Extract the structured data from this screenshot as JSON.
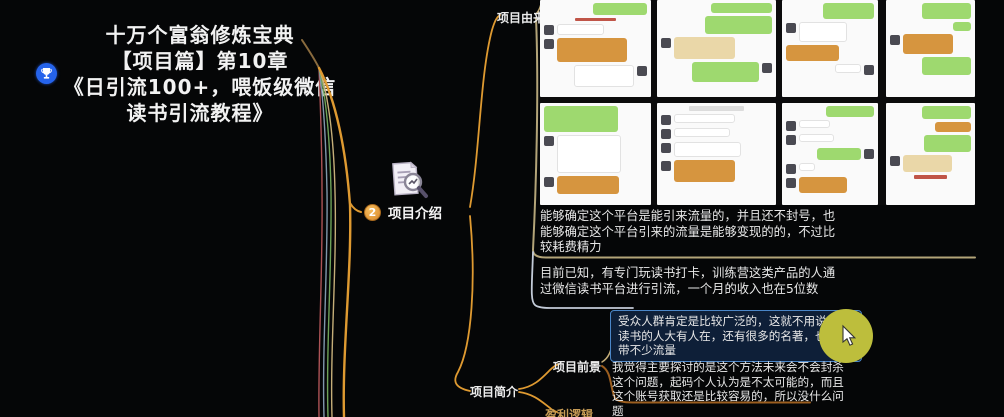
{
  "root_node": {
    "title_lines": [
      "十万个富翁修炼宝典",
      "【项目篇】第10章",
      "《日引流100+，喂饭级微信",
      "读书引流教程》"
    ],
    "marker_icon": "trophy-icon"
  },
  "intro_node": {
    "badge_number": "2",
    "label": "项目介绍",
    "icon": "document-search-icon"
  },
  "branch_labels": {
    "origin": "项目由来",
    "prospect": "项目前景",
    "summary": "项目简介",
    "profit": "盈利逻辑"
  },
  "notes": {
    "note1": "能够确定这个平台是能引来流量的，并且还不封号，也能够确定这个平台引来的流量是能够变现的的，不过比较耗费精力",
    "note2": "目前已知，有专门玩读书打卡，训练营这类产品的人通过微信读书平台进行引流，一个月的收入也在5位数",
    "note3_selected": "受众人群肯定是比较广泛的，这就不用说了，读书的人大有人在，还有很多的名著，也都自带不少流量",
    "note4": "我觉得主要探讨的是这个方法未来会不会封杀这个问题，起码个人认为是不太可能的，而且这个账号获取还是比较容易的，所以没什么问题"
  },
  "colors": {
    "background": "#050607",
    "branch_orange": "#df9a31",
    "branch_tan": "#c5ae79",
    "branch_green": "#6da257",
    "branch_slate": "#8097ab",
    "branch_red": "#ad5356",
    "underline_tan": "#b3a478",
    "underline_light": "#c3cbd8",
    "underline_brown": "#9c5e1f",
    "selection_border": "#4a86c8",
    "selection_bg": "#0e1f38",
    "cursor_highlight": "#bdbe3c",
    "badge_orange": "#e8a33c",
    "marker_blue": "#2563eb",
    "wechat_green": "#9ed96f",
    "bubble_orange": "#d6953f",
    "bubble_beige": "#ead7a8"
  },
  "collage": {
    "description": "wechat-chat-screenshot-collage",
    "cells": [
      {
        "x": 0,
        "y": 0,
        "w": 111,
        "h": 97,
        "bubbles": [
          {
            "s": "r",
            "c": "green",
            "w": 52,
            "h": 12
          },
          {
            "s": "m",
            "c": "redline",
            "w": 40,
            "h": 3
          },
          {
            "s": "l",
            "c": "white",
            "w": 46,
            "h": 11,
            "av": 1
          },
          {
            "s": "l",
            "c": "orange",
            "w": 68,
            "h": 24,
            "av": 1
          },
          {
            "s": "r",
            "c": "white",
            "w": 58,
            "h": 22,
            "av": 1
          }
        ]
      },
      {
        "x": 117,
        "y": 0,
        "w": 119,
        "h": 97,
        "bubbles": [
          {
            "s": "r",
            "c": "green",
            "w": 55,
            "h": 10
          },
          {
            "s": "r",
            "c": "green",
            "w": 60,
            "h": 18
          },
          {
            "s": "l",
            "c": "beige",
            "w": 55,
            "h": 22,
            "av": 1
          },
          {
            "s": "r",
            "c": "green",
            "w": 60,
            "h": 20,
            "av": 1
          }
        ]
      },
      {
        "x": 242,
        "y": 0,
        "w": 96,
        "h": 97,
        "bubbles": [
          {
            "s": "r",
            "c": "green",
            "w": 58,
            "h": 16
          },
          {
            "s": "l",
            "c": "white",
            "w": 55,
            "h": 20,
            "av": 1
          },
          {
            "s": "l",
            "c": "orange",
            "w": 60,
            "h": 16
          },
          {
            "s": "r",
            "c": "white",
            "w": 30,
            "h": 9,
            "av": 1
          }
        ]
      },
      {
        "x": 346,
        "y": 0,
        "w": 89,
        "h": 97,
        "bubbles": [
          {
            "s": "r",
            "c": "green",
            "w": 60,
            "h": 16
          },
          {
            "s": "r",
            "c": "green",
            "w": 22,
            "h": 9
          },
          {
            "s": "l",
            "c": "orange",
            "w": 62,
            "h": 20,
            "av": 1
          },
          {
            "s": "r",
            "c": "green",
            "w": 60,
            "h": 18
          }
        ]
      },
      {
        "x": 0,
        "y": 103,
        "w": 111,
        "h": 102,
        "bubbles": [
          {
            "s": "l",
            "c": "green",
            "w": 72,
            "h": 26
          },
          {
            "s": "l",
            "c": "white",
            "w": 62,
            "h": 38,
            "av": 1
          },
          {
            "s": "l",
            "c": "orange",
            "w": 60,
            "h": 18,
            "av": 1
          }
        ]
      },
      {
        "x": 117,
        "y": 103,
        "w": 119,
        "h": 102,
        "bubbles": [
          {
            "s": "m",
            "c": "grayline",
            "w": 50,
            "h": 5
          },
          {
            "s": "l",
            "c": "white",
            "w": 55,
            "h": 9,
            "av": 1
          },
          {
            "s": "l",
            "c": "white",
            "w": 50,
            "h": 9,
            "av": 1
          },
          {
            "s": "l",
            "c": "white",
            "w": 60,
            "h": 15,
            "av": 1
          },
          {
            "s": "l",
            "c": "orange",
            "w": 55,
            "h": 22,
            "av": 1
          }
        ]
      },
      {
        "x": 242,
        "y": 103,
        "w": 96,
        "h": 102,
        "bubbles": [
          {
            "s": "r",
            "c": "green",
            "w": 55,
            "h": 11
          },
          {
            "s": "l",
            "c": "white",
            "w": 35,
            "h": 8,
            "av": 1
          },
          {
            "s": "l",
            "c": "white",
            "w": 40,
            "h": 8,
            "av": 1
          },
          {
            "s": "r",
            "c": "green",
            "w": 50,
            "h": 12,
            "av": 1
          },
          {
            "s": "l",
            "c": "white",
            "w": 18,
            "h": 8,
            "av": 1
          },
          {
            "s": "l",
            "c": "orange",
            "w": 55,
            "h": 16,
            "av": 1
          }
        ]
      },
      {
        "x": 346,
        "y": 103,
        "w": 89,
        "h": 102,
        "bubbles": [
          {
            "s": "r",
            "c": "green",
            "w": 60,
            "h": 13
          },
          {
            "s": "r",
            "c": "orange",
            "w": 45,
            "h": 10
          },
          {
            "s": "r",
            "c": "green",
            "w": 58,
            "h": 17
          },
          {
            "s": "l",
            "c": "beige",
            "w": 60,
            "h": 17,
            "av": 1
          },
          {
            "s": "m",
            "c": "redline",
            "w": 40,
            "h": 4
          }
        ]
      }
    ]
  }
}
